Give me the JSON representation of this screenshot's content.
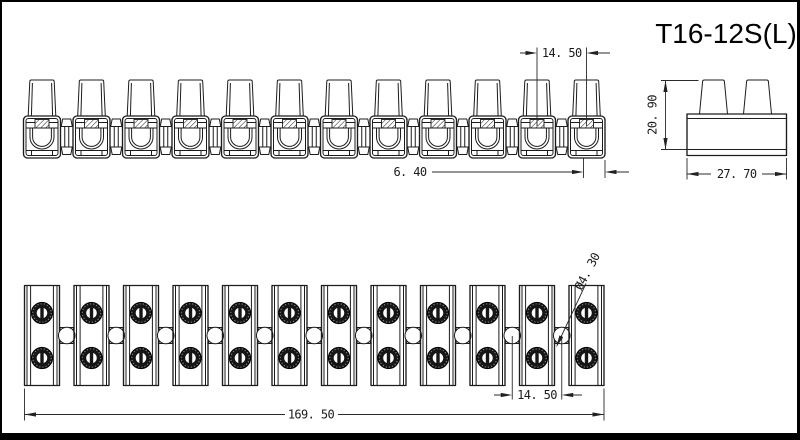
{
  "title": "T16-12S(L)",
  "drawing": {
    "front_view": {
      "units": 12
    },
    "side_view": {
      "towers": 2
    },
    "top_view": {
      "units": 12,
      "screws_per_unit": 2,
      "connectors": 11
    }
  },
  "dimensions": {
    "pitch_top": "14. 50",
    "wire_slot": "6. 40",
    "height": "20. 90",
    "depth": "27. 70",
    "total_length": "169. 50",
    "pitch_bottom": "14. 50",
    "hole_dia": "Ø4. 30"
  },
  "colors": {
    "line": "#1c1c1c",
    "screw_fill": "#161616",
    "sheet": "#ffffff",
    "frame": "#000000"
  }
}
